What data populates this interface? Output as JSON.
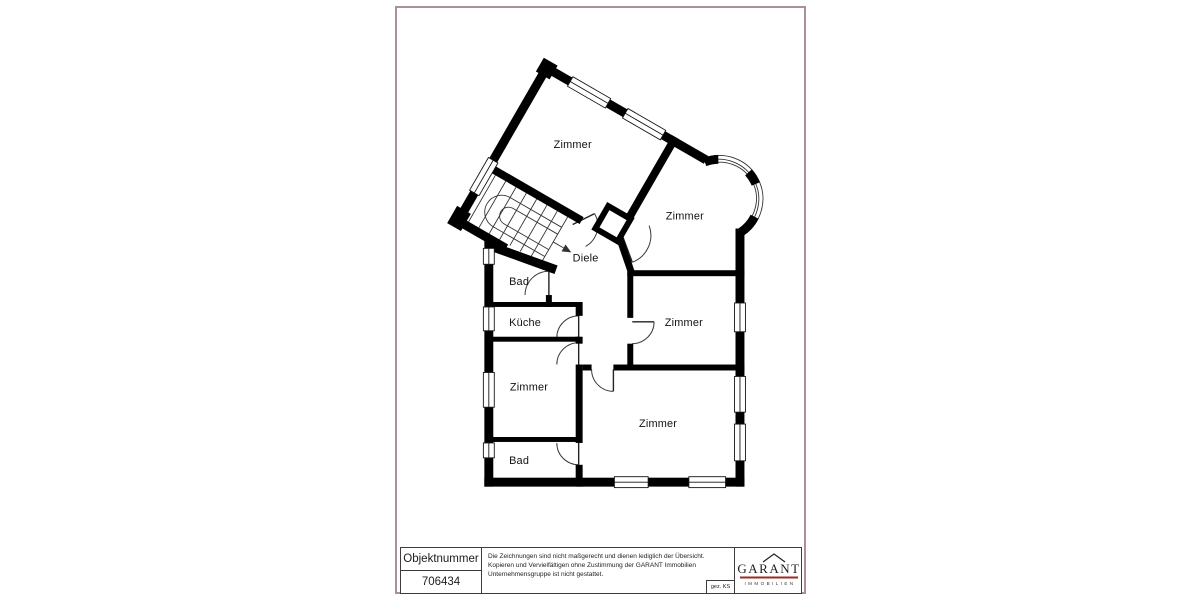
{
  "page": {
    "frame_color": "#ab9194"
  },
  "floor_plan": {
    "rooms": [
      {
        "name": "zimmer-wing-left",
        "label": "Zimmer"
      },
      {
        "name": "zimmer-wing-right",
        "label": "Zimmer"
      },
      {
        "name": "diele",
        "label": "Diele"
      },
      {
        "name": "bad-upper",
        "label": "Bad"
      },
      {
        "name": "kueche",
        "label": "Küche"
      },
      {
        "name": "zimmer-middle-right",
        "label": "Zimmer"
      },
      {
        "name": "zimmer-left",
        "label": "Zimmer"
      },
      {
        "name": "zimmer-bottom",
        "label": "Zimmer"
      },
      {
        "name": "bad-lower",
        "label": "Bad"
      }
    ]
  },
  "title_block": {
    "object_number_label": "Objektnummer",
    "object_number": "706434",
    "disclaimer": "Die Zeichnungen sind nicht maßgerecht und dienen lediglich der Übersicht. Kopieren und Vervielfältigen ohne Zustimmung der GARANT Immobilien Unternehmensgruppe ist nicht gestattet.",
    "drawn_by": "gez. KS",
    "logo": {
      "brand": "GARANT",
      "tagline": "IMMOBILIEN",
      "rule_color": "#9e2b25"
    }
  }
}
